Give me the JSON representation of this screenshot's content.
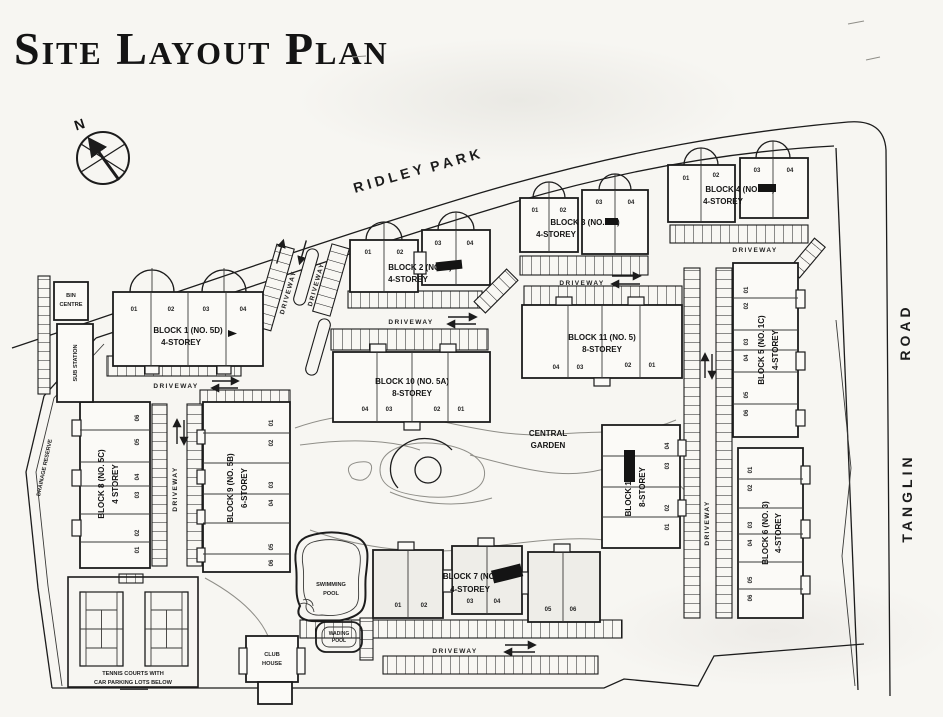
{
  "title": "Site Layout Plan",
  "compass": {
    "north_label": "N"
  },
  "roads": {
    "ridley_word1": "RIDLEY",
    "ridley_word2": "PARK",
    "tanglin_word1": "TANGLIN",
    "tanglin_word2": "ROAD",
    "drainage_reserve": "DRAINAGE RESERVE"
  },
  "labels": {
    "driveway": "DRIVEWAY",
    "central_garden_line1": "CENTRAL",
    "central_garden_line2": "GARDEN"
  },
  "facilities": {
    "bin_centre_line1": "BIN",
    "bin_centre_line2": "CENTRE",
    "sub_station": "SUB STATION",
    "swimming_pool_line1": "SWIMMING",
    "swimming_pool_line2": "POOL",
    "wading_pool_line1": "WADING",
    "wading_pool_line2": "POOL",
    "club_house_line1": "CLUB",
    "club_house_line2": "HOUSE",
    "tennis_line1": "TENNIS COURTS WITH",
    "tennis_line2": "CAR PARKING LOTS BELOW"
  },
  "blocks": [
    {
      "name": "BLOCK 1 (NO. 5D)",
      "storey": "4-STOREY",
      "units": [
        "01",
        "02",
        "03",
        "04"
      ]
    },
    {
      "name": "BLOCK 2 (NO. 1)",
      "storey": "4-STOREY",
      "units": [
        "01",
        "02",
        "03",
        "04"
      ],
      "redacted": true
    },
    {
      "name": "BLOCK 3 (NO. 1A)",
      "storey": "4-STOREY",
      "units": [
        "01",
        "02",
        "03",
        "04"
      ],
      "redacted": true
    },
    {
      "name": "BLOCK 4 (NO. 1B)",
      "storey": "4-STOREY",
      "units": [
        "01",
        "02",
        "03",
        "04"
      ],
      "redacted": true
    },
    {
      "name": "BLOCK 5 (NO. 1C)",
      "storey": "4-STOREY",
      "units": [
        "01",
        "02",
        "03",
        "04",
        "05",
        "06"
      ]
    },
    {
      "name": "BLOCK 6 (NO. 3)",
      "storey": "4-STOREY",
      "units": [
        "01",
        "02",
        "03",
        "04",
        "05",
        "06"
      ]
    },
    {
      "name": "BLOCK 7 (NO.",
      "storey": "4-STOREY",
      "units": [
        "01",
        "02",
        "03",
        "04",
        "05",
        "06"
      ],
      "redacted": true
    },
    {
      "name": "BLOCK 8 (NO. 5C)",
      "storey": "4 STOREY",
      "units": [
        "06",
        "05",
        "04",
        "03",
        "02",
        "01"
      ]
    },
    {
      "name": "BLOCK 9 (NO. 5B)",
      "storey": "6-STOREY",
      "units": [
        "01",
        "02",
        "03",
        "04",
        "05",
        "06"
      ]
    },
    {
      "name": "BLOCK 10 (NO. 5A)",
      "storey": "8-STOREY",
      "units": [
        "04",
        "03",
        "02",
        "01"
      ]
    },
    {
      "name": "BLOCK 11 (NO. 5)",
      "storey": "8-STOREY",
      "units": [
        "04",
        "03",
        "02",
        "01"
      ]
    },
    {
      "name": "BLOCK 12 (NO.",
      "storey": "8-STOREY",
      "units": [
        "04",
        "03",
        "02",
        "01"
      ],
      "redacted": true
    }
  ],
  "colors": {
    "ink": "#1c1c1c",
    "paper": "#f7f6f2"
  }
}
